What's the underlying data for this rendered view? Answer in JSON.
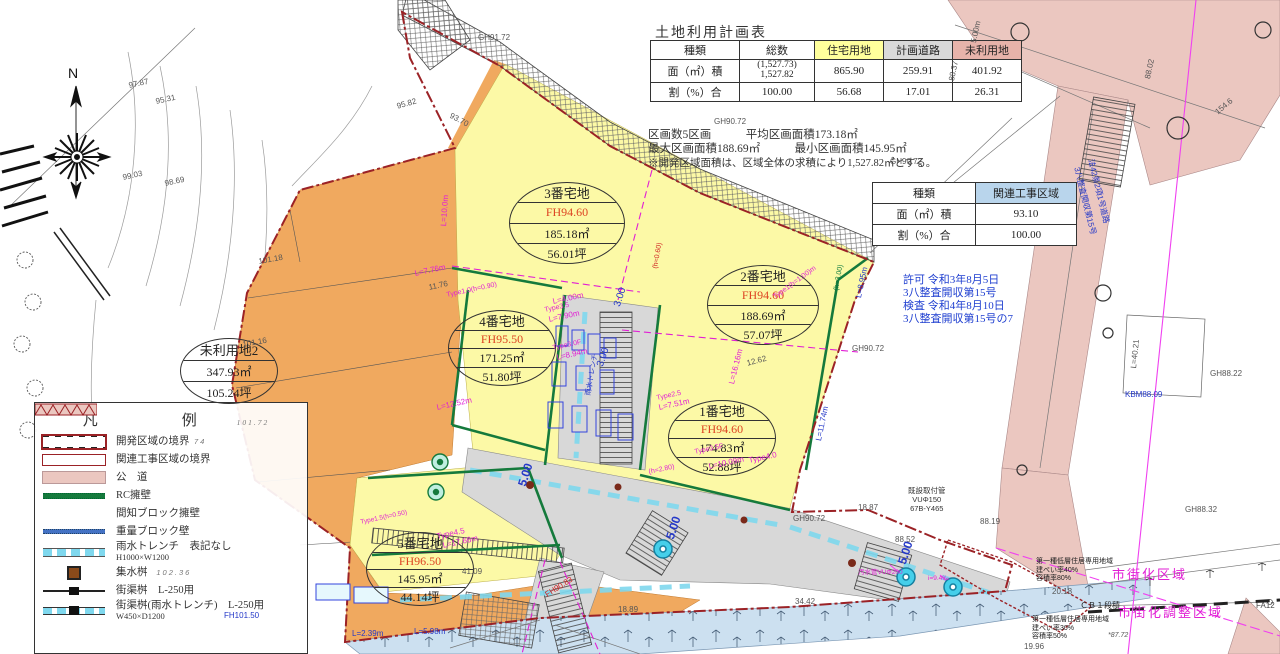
{
  "palette": {
    "residential_yellow": "#fcf9a6",
    "unused_orange": "#f0a95f",
    "road_gray": "#d8d8d8",
    "public_pink": "#ebc7c0",
    "water_blue": "#cce0f0",
    "trench_cyan": "#7fd8ee",
    "boundary_red": "#9b2226",
    "magenta": "#e11fd4",
    "anno_blue": "#2438c8",
    "wall_green": "#157a3c"
  },
  "compass": {
    "label": "N"
  },
  "land_use_table": {
    "title": "土地利用計画表",
    "headers": [
      "種類",
      "総数",
      "住宅用地",
      "計画道路",
      "未利用地"
    ],
    "row_area": {
      "label": "面（㎡）積",
      "total_paren": "(1,527.73)",
      "total": "1,527.82",
      "residential": "865.90",
      "road": "259.91",
      "unused": "401.92"
    },
    "row_ratio": {
      "label": "割（%）合",
      "total": "100.00",
      "residential": "56.68",
      "road": "17.01",
      "unused": "26.31"
    },
    "notes": [
      "区画数5区画　　　平均区画面積173.18㎡",
      "最大区画面積188.69㎡　　　最小区画面積145.95㎡",
      "※開発区域面積は、区域全体の求積により1,527.82㎡とする。"
    ]
  },
  "related_table": {
    "type_label": "種類",
    "zone_label": "関連工事区域",
    "area_label": "面（㎡）積",
    "area_value": "93.10",
    "ratio_label": "割（%）合",
    "ratio_value": "100.00"
  },
  "permit_text": [
    "許可 令和3年8月5日",
    "3八整査開収第15号",
    "検査 令和4年8月10日",
    "3八整査開収第15号の7"
  ],
  "legend": {
    "title": "凡　　例",
    "title_note": "101.72",
    "items": [
      {
        "label": "開発区域の境界",
        "note": "74"
      },
      {
        "label": "関連工事区域の境界",
        "note": ""
      },
      {
        "label": "公　道",
        "note": ""
      },
      {
        "label": "RC擁壁",
        "note": ""
      },
      {
        "label": "間知ブロック擁壁",
        "note": ""
      },
      {
        "label": "重量ブロック壁",
        "note": ""
      },
      {
        "label": "雨水トレンチ　表記なし",
        "label2": "H1000×W1200",
        "note": ""
      },
      {
        "label": "集水桝",
        "note": "102.36"
      },
      {
        "label": "街渠桝　L-250用",
        "note": ""
      },
      {
        "label": "街渠桝(雨水トレンチ)",
        "label2": "W450×D1200",
        "note": "L-250用"
      }
    ]
  },
  "parcels": [
    {
      "name": "3番宅地",
      "fh": "FH94.60",
      "area": "185.18㎡",
      "tsubo": "56.01坪"
    },
    {
      "name": "2番宅地",
      "fh": "FH94.60",
      "area": "188.69㎡",
      "tsubo": "57.07坪"
    },
    {
      "name": "4番宅地",
      "fh": "FH95.50",
      "area": "171.25㎡",
      "tsubo": "51.80坪"
    },
    {
      "name": "1番宅地",
      "fh": "FH94.60",
      "area": "174.83㎡",
      "tsubo": "52.88坪"
    },
    {
      "name": "5番宅地",
      "fh": "FH96.50",
      "area": "145.95㎡",
      "tsubo": "44.14坪"
    },
    {
      "name": "未利用地2",
      "area": "347.93㎡",
      "tsubo": "105.24坪"
    }
  ],
  "zoning": {
    "upper": [
      "第一種低層住居専用地域",
      "建ぺい率40%",
      "容積率80%"
    ],
    "upper_zone": "市街化区域",
    "mid": "ＣＢ１段積",
    "lower": [
      "第一種低層住居専用地域",
      "建ぺい率30%",
      "容積率50%"
    ],
    "lower_zone": "市街化調整区域",
    "spot": "*87.72",
    "point": "FA12"
  },
  "road_note": [
    "法42条2項1号道路",
    "3八整査開収第15号"
  ],
  "pipe_note": [
    "既設取付管",
    "VUΦ150",
    "67B-Y465"
  ],
  "annotations": [
    "GH91.72",
    "GH90.72",
    "GH90.72",
    "GH90.72",
    "GH90.72",
    "GH88.22",
    "GH88.32",
    "KBM88.09",
    "88.52",
    "18.87",
    "88.19",
    "34.42",
    "18.89",
    "20.18",
    "19.96",
    "41.09",
    "97.87",
    "95.31",
    "99.03",
    "98.69",
    "95.82",
    "101.18",
    "101.16",
    "154.6",
    "88.02",
    "88.37",
    "5.00m",
    "5.00",
    "5.00",
    "5.00",
    "3.00",
    "3.00",
    "12.62",
    "L=8.95m",
    "L=11.74m",
    "L=40.21",
    "L=10.0m",
    "L=7.76m",
    "11.76",
    "Type1.0(h=0.90)",
    "L=4.00m",
    "Type3.5",
    "L=7.90m",
    "Type3.0F",
    "L=8.94m",
    "L=12.52m",
    "Type2.5",
    "L=7.51m",
    "Type3.5F",
    "L=10.09m",
    "Type4.0",
    "(h=2.80)",
    "(h=3.00)",
    "Type1(h=1.00)m",
    "Type4.5",
    "L=17.66m",
    "Type1.5(h=0.50)",
    "L=2.39m",
    "L=5.98m",
    "FH101.50",
    "FH90.83",
    "L=16.16m",
    "雨水トレンチ",
    "汚水管VUΦ200",
    "i=9.4‰",
    "(h=0.60)",
    "93.70"
  ]
}
